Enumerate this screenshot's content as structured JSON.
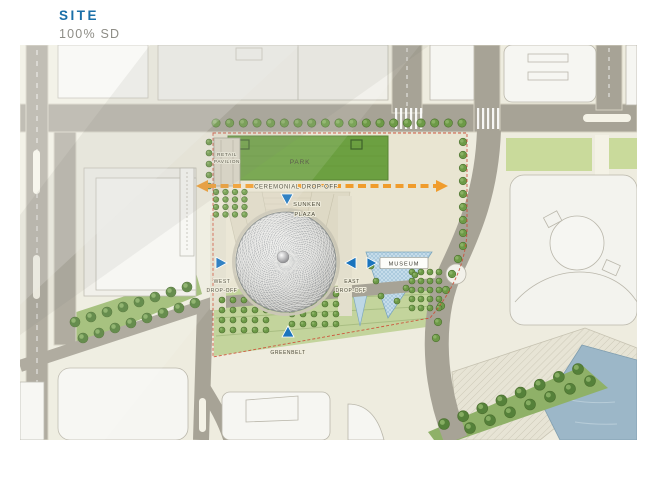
{
  "header": {
    "title": "SITE",
    "subtitle": "100% SD"
  },
  "plan": {
    "labels": {
      "park": "PARK",
      "retail_line1": "RETAIL",
      "retail_line2": "PAVILION",
      "ceremonial_dropoff": "CEREMONIAL DROP-OFF",
      "sunken_line1": "SUNKEN",
      "sunken_line2": "PLAZA",
      "west_line1": "WEST",
      "west_line2": "DROP-OFF",
      "east_line1": "EAST",
      "east_line2": "DROP-OFF",
      "museum": "MUSEUM",
      "greenbelt": "GREENBELT"
    },
    "colors": {
      "title_blue": "#1a6fa8",
      "subtitle_gray": "#8e8d86",
      "map_base": "#eeecdf",
      "road": "#a7a396",
      "road_edge": "#d5d2c2",
      "building": "#f6f6f2",
      "building_stroke": "#bab7ab",
      "park_green": "#6ca041",
      "lawn_green": "#c9da9b",
      "tree_green": "#6d9a47",
      "tree_dark": "#4d7030",
      "belt_green": "#55813a",
      "museum_blue": "#c5dcea",
      "water_blue": "#9cb7c8",
      "marker_blue": "#1b74bd",
      "arrow_orange": "#f09c2c",
      "boundary_red": "#cd4a33",
      "dome_gray": "#c9c9c7"
    }
  }
}
